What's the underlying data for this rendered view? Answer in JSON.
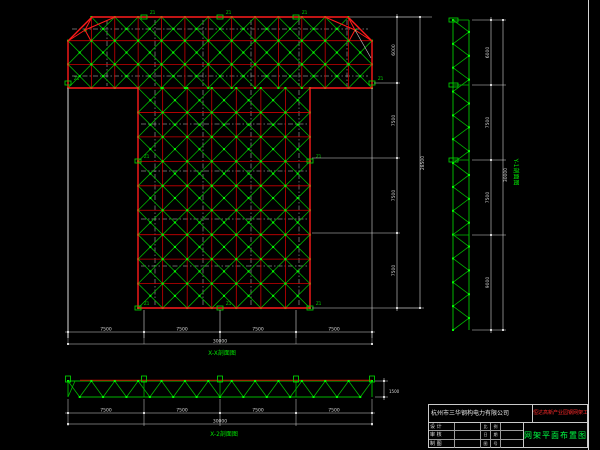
{
  "colors": {
    "bg": "#000000",
    "grid_red": "#cc0000",
    "outline_red": "#ff1a1a",
    "member_green": "#00b400",
    "node_green": "#00ff00",
    "support_green": "#00e000",
    "centerline_white": "#cfcfcf",
    "dim_white": "#d8d8d8",
    "gray_line": "#8a8a8a",
    "label_green": "#00e000",
    "project_red": "#ff2a2a",
    "title_green": "#00ff44"
  },
  "plan": {
    "section_label": "X-X剖面图",
    "support_label": "Z1",
    "band": {
      "x": 68,
      "y": 17,
      "cols": 13,
      "rows": 3,
      "cw": 23.38,
      "ch": 23.67
    },
    "column": {
      "x": 138.1,
      "y": 88,
      "cols": 7,
      "rows": 9,
      "cw": 24.55,
      "ch": 24.45
    },
    "supports": [
      [
        144,
        17
      ],
      [
        220,
        17
      ],
      [
        296,
        17
      ],
      [
        68,
        83
      ],
      [
        372,
        83
      ],
      [
        138,
        161
      ],
      [
        310,
        161
      ],
      [
        138,
        308
      ],
      [
        220,
        308
      ],
      [
        310,
        308
      ]
    ],
    "dims_bottom": {
      "y": 332,
      "ticks": [
        68,
        144,
        220,
        296,
        372
      ],
      "labels": [
        "7500",
        "7500",
        "7500",
        "7500"
      ],
      "overall_y": 344,
      "overall": "30000"
    },
    "dims_right": {
      "x": 397,
      "ticks": [
        17,
        83,
        158,
        233,
        308
      ],
      "labels": [
        "6000",
        "7500",
        "7500",
        "7500"
      ],
      "overall_x": 420,
      "overall": "28500"
    }
  },
  "ytruss": {
    "label": "Y-1剖面图",
    "x_left": 453,
    "x_right": 469,
    "y0": 20,
    "y1": 330,
    "bays": 13,
    "dims": {
      "x": 491,
      "ticks": [
        20,
        85,
        160,
        235,
        330
      ],
      "labels": [
        "6000",
        "7500",
        "7500",
        "9000"
      ],
      "overall_x": 503,
      "overall": "30000"
    }
  },
  "xtruss": {
    "label": "X-2剖面图",
    "x0": 68,
    "x1": 372,
    "y_top": 381,
    "y_bot": 397,
    "bays": 13,
    "dims": {
      "y": 413,
      "ticks": [
        68,
        144,
        220,
        296,
        372
      ],
      "labels": [
        "7500",
        "7500",
        "7500",
        "7500"
      ],
      "overall_y": 424,
      "overall": "30000",
      "height": "1500"
    }
  },
  "titleblock": {
    "company": "杭州市三华钢构电力有限公司",
    "project": "恒达高新产业园钢网架工程",
    "drawing_title": "网架平面布置图",
    "rows": [
      {
        "label": "设 计",
        "a": "比",
        "b": "例"
      },
      {
        "label": "审 核",
        "a": "日",
        "b": "期"
      },
      {
        "label": "制 图",
        "a": "图",
        "b": "号"
      }
    ]
  }
}
